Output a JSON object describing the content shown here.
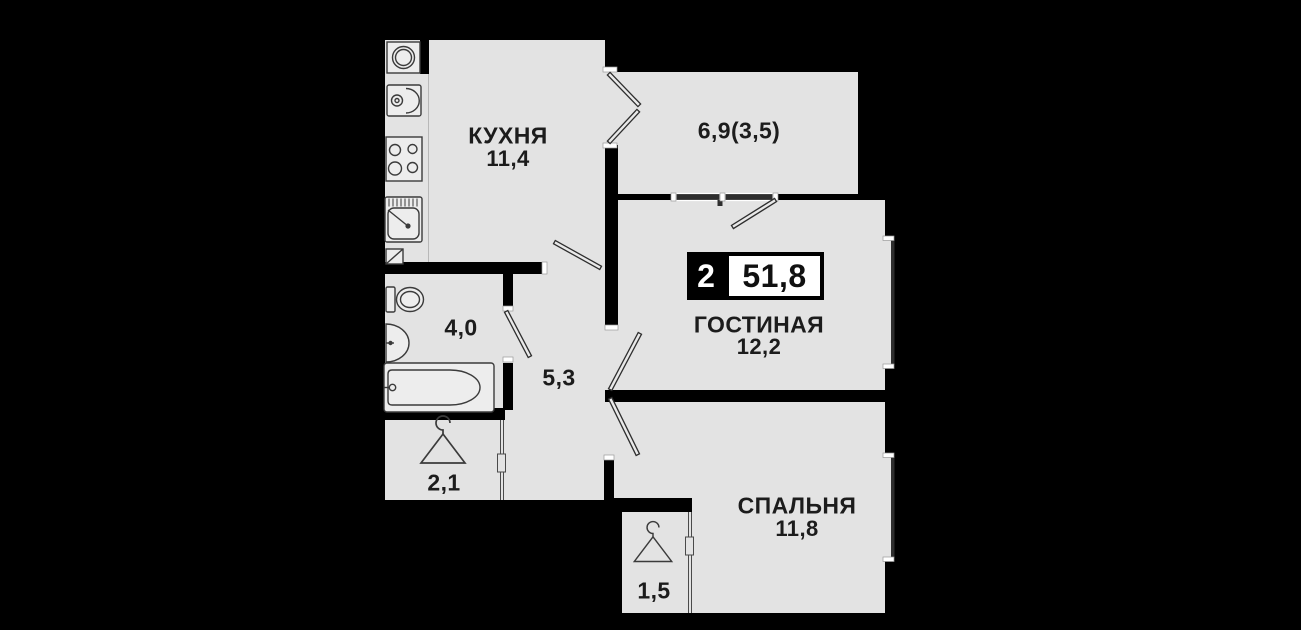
{
  "badge": {
    "room_count": "2",
    "total_area": "51,8"
  },
  "rooms": {
    "kitchen": {
      "label": "КУХНЯ",
      "area": "11,4"
    },
    "balcony": {
      "area": "6,9(3,5)"
    },
    "living_room": {
      "label": "ГОСТИНАЯ",
      "area": "12,2"
    },
    "bedroom": {
      "label": "СПАЛЬНЯ",
      "area": "11,8"
    },
    "bathroom": {
      "area": "4,0"
    },
    "hallway": {
      "area": "5,3"
    },
    "wardrobe": {
      "area": "2,1"
    },
    "closet": {
      "area": "1,5"
    }
  },
  "icons": {
    "kitchen": [
      "washing-machine-icon",
      "fridge-icon",
      "stove-icon",
      "kitchen-sink-icon",
      "vent-icon"
    ],
    "bathroom": [
      "toilet-icon",
      "washbasin-icon",
      "bathtub-icon"
    ],
    "wardrobe": [
      "hanger-icon"
    ],
    "closet": [
      "hanger-icon"
    ]
  },
  "colors": {
    "background": "#000000",
    "floor": "#e3e3e3",
    "walls": "#000000",
    "text": "#1c1c1c",
    "window_glass": "#2e2e2e",
    "badge_black": "#000000",
    "badge_white": "#ffffff"
  }
}
